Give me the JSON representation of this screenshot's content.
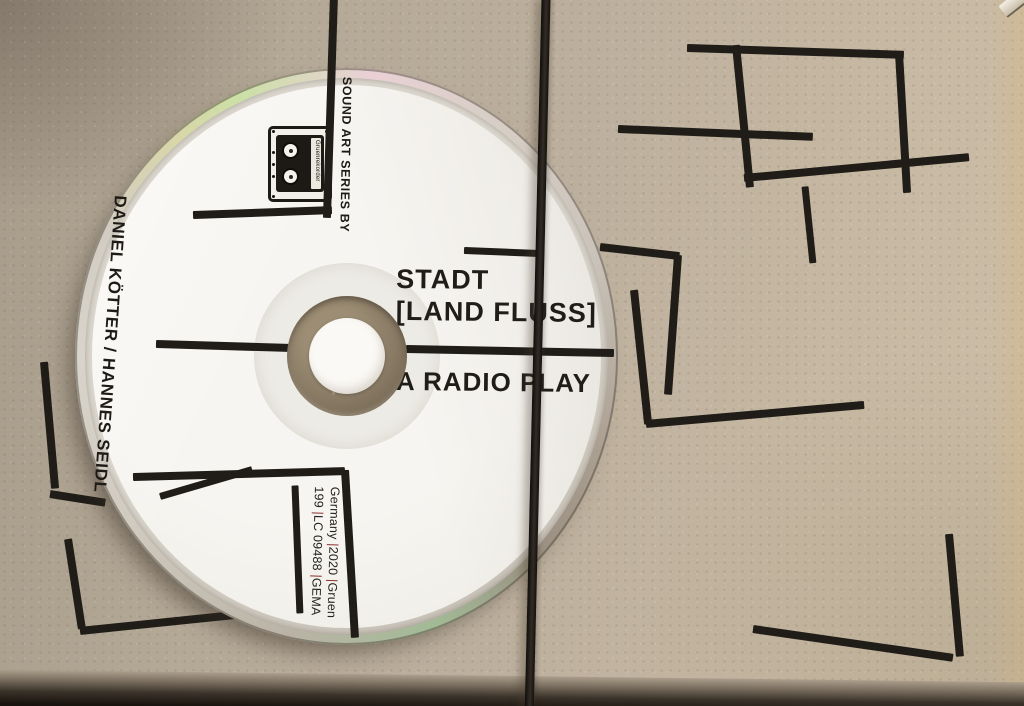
{
  "disc": {
    "series_label": "SOUND ART SERIES BY",
    "artists": "DANIEL KÖTTER / HANNES SEIDL",
    "title_line1": "STADT",
    "title_line2": "[LAND FLUSS]",
    "subtitle": "A RADIO PLAY",
    "cassette_logo_text": "Gruenrekorder",
    "info_lines": [
      [
        {
          "t": "Germany "
        },
        {
          "t": "|",
          "red": true
        },
        {
          "t": "2020 "
        },
        {
          "t": "|",
          "red": true
        },
        {
          "t": "Gruen"
        }
      ],
      [
        {
          "t": "199 "
        },
        {
          "t": "|",
          "red": true
        },
        {
          "t": "LC 09488 "
        },
        {
          "t": "|",
          "red": true
        },
        {
          "t": "GEMA"
        }
      ]
    ]
  },
  "colors": {
    "cardboard": "#b9ac9a",
    "label_white": "#f4f2ed",
    "ink_black": "#201d18",
    "pipe_accent": "#8a302c",
    "rubber_band": "#221e19"
  }
}
